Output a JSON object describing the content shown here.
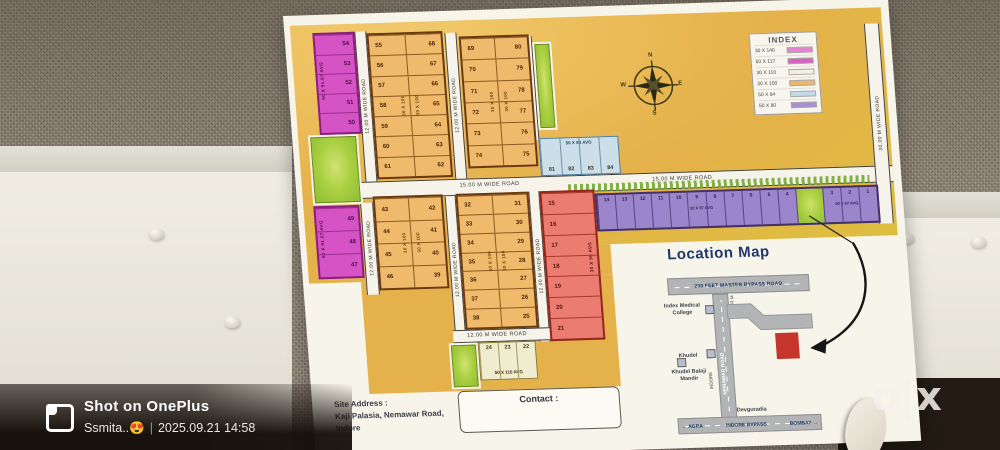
{
  "photo_watermark": {
    "brand": "Shot on OnePlus",
    "byline": "Ssmita..😍",
    "divider": "|",
    "datetime": "2025.09.21 14:58"
  },
  "marketplace_logo": "o|x",
  "poster": {
    "index": {
      "title": "INDEX",
      "rows": [
        {
          "size": "30 X 140",
          "color": "#e483cf"
        },
        {
          "size": "50 X 117",
          "color": "#db5fc3"
        },
        {
          "size": "30 X 110",
          "color": "#f5efe2"
        },
        {
          "size": "30 X 100",
          "color": "#eeb668"
        },
        {
          "size": "50 X 84",
          "color": "#c3d9e8"
        },
        {
          "size": "50 X 80",
          "color": "#a88fd2"
        }
      ]
    },
    "compass": {
      "n": "N",
      "e": "E",
      "s": "S",
      "w": "W"
    },
    "roads": {
      "wide12": "12.00 M WIDE ROAD",
      "wide15": "15.00 M WIDE ROAD",
      "wide30": "30.00 M WIDE ROAD"
    },
    "blocks": {
      "pink_top": {
        "size": "50 X 91.67 AVG",
        "plots": [
          "54",
          "53",
          "52",
          "51",
          "50"
        ]
      },
      "pink_mid": {
        "size": "50 X 91.67 AVG",
        "plots": [
          "49",
          "48",
          "47"
        ]
      },
      "orange_a": {
        "size": "30 X 100",
        "left": [
          "55",
          "56",
          "57",
          "58",
          "59",
          "60",
          "61"
        ],
        "right": [
          "68",
          "67",
          "66",
          "65",
          "64",
          "63",
          "62"
        ]
      },
      "orange_b": {
        "size": "30 X 100",
        "left": [
          "69",
          "70",
          "71",
          "72",
          "73",
          "74"
        ],
        "right": [
          "80",
          "79",
          "78",
          "77",
          "76",
          "75"
        ]
      },
      "blue": {
        "size": "50 X 84 AVG",
        "plots": [
          "81",
          "82",
          "83",
          "84"
        ]
      },
      "orange_c": {
        "size": "30 X 100",
        "left": [
          "43",
          "44",
          "45",
          "46"
        ],
        "right": [
          "42",
          "41",
          "40",
          "39"
        ]
      },
      "orange_d": {
        "size": "30 X 100",
        "left": [
          "32",
          "33",
          "34",
          "35",
          "36",
          "37",
          "38"
        ],
        "right": [
          "31",
          "30",
          "29",
          "28",
          "27",
          "26",
          "25"
        ]
      },
      "red": {
        "size": "30 X 90 AVG",
        "plots": [
          "15",
          "16",
          "17",
          "18",
          "19",
          "20",
          "21"
        ]
      },
      "purple": {
        "size_a": "32 X 97 AVG",
        "size_b": "50 X 97 AVG",
        "cells": [
          "14",
          "13",
          "12",
          "11",
          "10",
          "9",
          "8",
          "7",
          "6",
          "5",
          "4",
          "GREEN",
          "3",
          "2",
          "1"
        ]
      },
      "cream": {
        "size": "50 X 110 AVG",
        "plots": [
          "24",
          "23",
          "22"
        ]
      }
    },
    "site_address": {
      "label": "Site Address :",
      "line1": "Kaji Palasia, Nemawar Road,",
      "line2": "Indore"
    },
    "contact_label": "Contact :",
    "location_map": {
      "title": "Location Map",
      "bypass_road": "200 FEET MASTER BYPASS ROAD",
      "nemawar_road": "NEMAWAR ROAD",
      "rajpur": "RAJPUR M",
      "indore": "INDORE",
      "poi_medical": "Index Medical College",
      "poi_khudel": "Khudel",
      "poi_mandir": "Khudel Balaji Mandir",
      "poi_devguradia": "Devguradia",
      "agra": "← AGRA",
      "bypass": "INDORE BYPASS",
      "bombay": "BOMBAY →"
    }
  }
}
